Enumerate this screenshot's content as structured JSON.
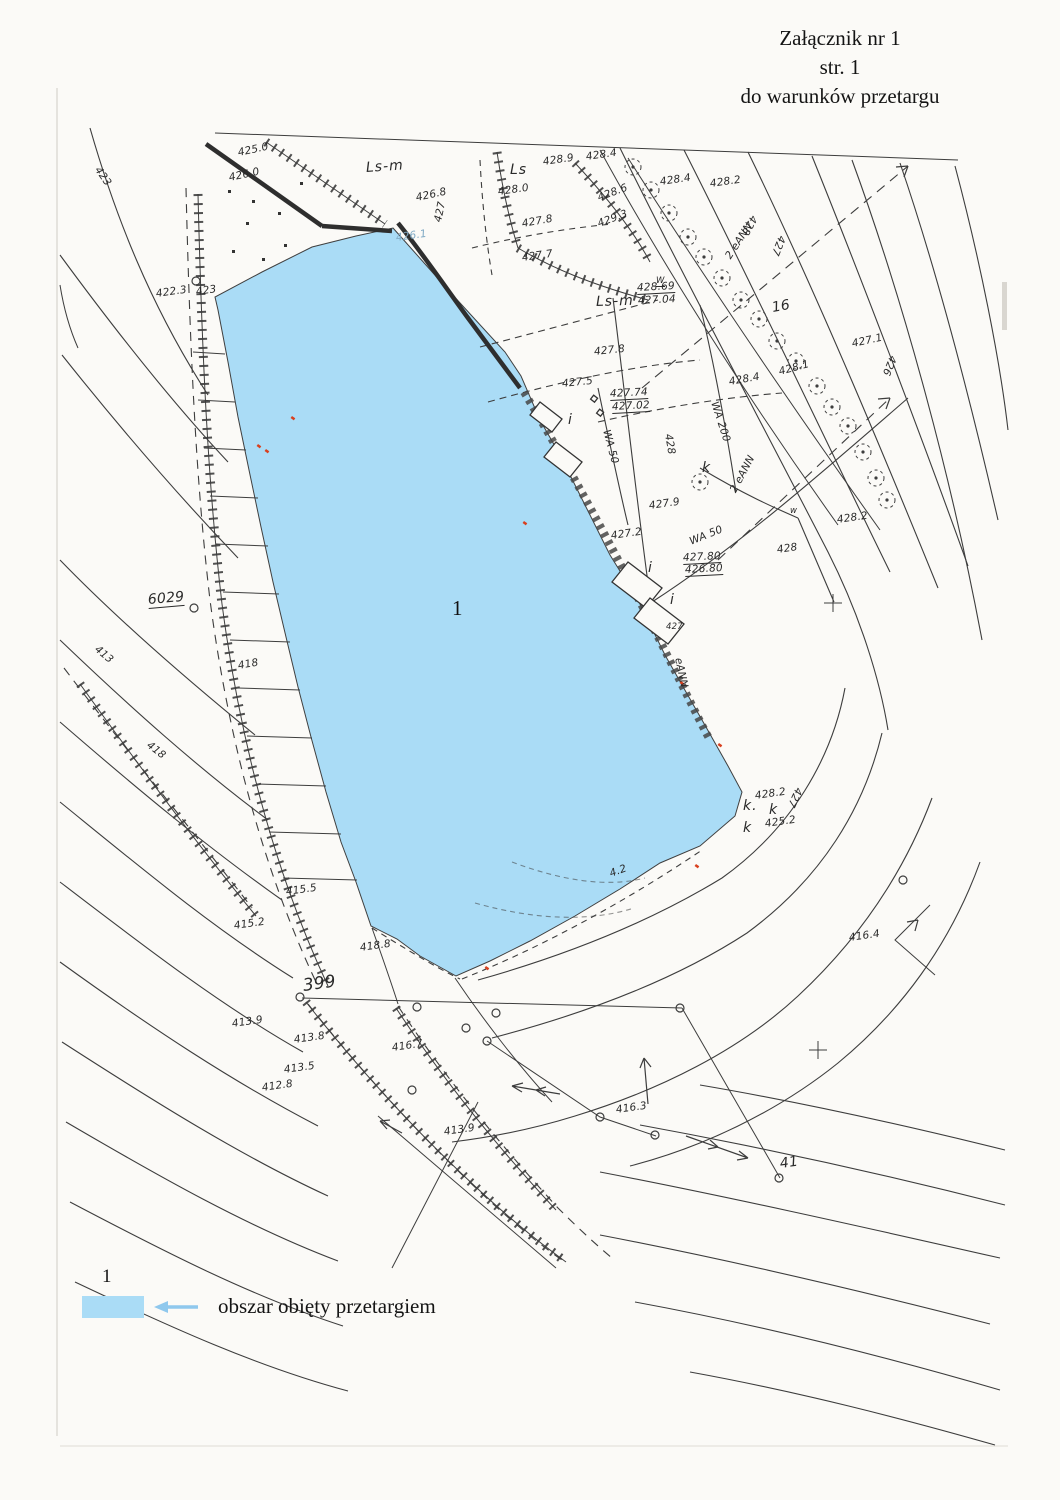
{
  "header": {
    "line1": "Załącznik nr 1",
    "line2": "str. 1",
    "line3": "do warunków przetargu"
  },
  "legend": {
    "area_number": "1",
    "label": "obszar obięty przetargiem",
    "swatch_color": "#aadcf6",
    "arrow_color": "#8fc8ed"
  },
  "map": {
    "area_label": "1",
    "water_color": "#aadcf6",
    "line_color": "#3d3d3d",
    "red_mark_color": "#d8401f",
    "labels": [
      {
        "t": "423",
        "x": 97,
        "y": 162,
        "r": 55
      },
      {
        "t": "425.0",
        "x": 238,
        "y": 147,
        "r": -12
      },
      {
        "t": "426.0",
        "x": 229,
        "y": 172,
        "r": -12
      },
      {
        "t": "Ls-m",
        "x": 366,
        "y": 160,
        "r": -4,
        "c": "ls"
      },
      {
        "t": "426.8",
        "x": 416,
        "y": 192,
        "r": -12
      },
      {
        "t": "427",
        "x": 438,
        "y": 216,
        "r": -78
      },
      {
        "t": "426.1",
        "x": 396,
        "y": 232,
        "r": -8,
        "c": "blue"
      },
      {
        "t": "Ls",
        "x": 510,
        "y": 162,
        "r": 0,
        "c": "ls"
      },
      {
        "t": "428.9",
        "x": 543,
        "y": 156,
        "r": -8
      },
      {
        "t": "428.4",
        "x": 586,
        "y": 151,
        "r": -8
      },
      {
        "t": "428.0",
        "x": 498,
        "y": 186,
        "r": -8
      },
      {
        "t": "428.6",
        "x": 598,
        "y": 192,
        "r": -20
      },
      {
        "t": "428.4",
        "x": 660,
        "y": 176,
        "r": -8
      },
      {
        "t": "428.2",
        "x": 710,
        "y": 178,
        "r": -8
      },
      {
        "t": "427.8",
        "x": 522,
        "y": 218,
        "r": -10
      },
      {
        "t": "429.3",
        "x": 598,
        "y": 218,
        "r": -20
      },
      {
        "t": "427.7",
        "x": 522,
        "y": 252,
        "r": -8
      },
      {
        "t": "2 eANN",
        "x": 728,
        "y": 252,
        "r": -57
      },
      {
        "t": "428",
        "x": 754,
        "y": 210,
        "r": 118
      },
      {
        "t": "427",
        "x": 782,
        "y": 230,
        "r": 112
      },
      {
        "t": "426",
        "x": 893,
        "y": 350,
        "r": 112
      },
      {
        "t": "427.1",
        "x": 852,
        "y": 338,
        "r": -12
      },
      {
        "t": "16",
        "x": 772,
        "y": 300,
        "r": -10,
        "c": "md"
      },
      {
        "t": "428.69",
        "x": 637,
        "y": 282,
        "r": -3,
        "u": 1
      },
      {
        "t": "427.04",
        "x": 638,
        "y": 295,
        "r": -3
      },
      {
        "t": "Ls-m",
        "x": 596,
        "y": 294,
        "r": -2,
        "c": "ls"
      },
      {
        "t": "427.8",
        "x": 594,
        "y": 346,
        "r": -6
      },
      {
        "t": "W",
        "x": 656,
        "y": 276,
        "r": 0,
        "u": 1,
        "c": "tiny"
      },
      {
        "t": "427.5",
        "x": 562,
        "y": 378,
        "r": -6
      },
      {
        "t": "427.74",
        "x": 610,
        "y": 388,
        "r": -3,
        "u": 1
      },
      {
        "t": "427.02",
        "x": 612,
        "y": 401,
        "r": -3,
        "u": 1
      },
      {
        "t": "i",
        "x": 568,
        "y": 412,
        "r": 0,
        "c": "ls"
      },
      {
        "t": "WA 50",
        "x": 606,
        "y": 424,
        "r": 75
      },
      {
        "t": "WA 200",
        "x": 714,
        "y": 396,
        "r": 72
      },
      {
        "t": "428.4",
        "x": 729,
        "y": 376,
        "r": -10
      },
      {
        "t": "428.1",
        "x": 779,
        "y": 366,
        "r": -15
      },
      {
        "t": "428",
        "x": 668,
        "y": 428,
        "r": 80
      },
      {
        "t": "k",
        "x": 702,
        "y": 460,
        "r": 0,
        "c": "ls"
      },
      {
        "t": "2 eANN",
        "x": 733,
        "y": 486,
        "r": -62
      },
      {
        "t": "427.9",
        "x": 649,
        "y": 500,
        "r": -8
      },
      {
        "t": "427.2",
        "x": 611,
        "y": 530,
        "r": -8
      },
      {
        "t": "428.2",
        "x": 837,
        "y": 514,
        "r": -8
      },
      {
        "t": "428",
        "x": 777,
        "y": 544,
        "r": -8
      },
      {
        "t": "427.80",
        "x": 683,
        "y": 552,
        "r": -3,
        "u": 1
      },
      {
        "t": "426.80",
        "x": 685,
        "y": 564,
        "r": -3,
        "u": 1
      },
      {
        "t": "i",
        "x": 648,
        "y": 560,
        "r": 0,
        "c": "ls"
      },
      {
        "t": "i",
        "x": 670,
        "y": 592,
        "r": 0,
        "c": "ls"
      },
      {
        "t": "427",
        "x": 666,
        "y": 622,
        "r": 0,
        "c": "tiny"
      },
      {
        "t": "eANN",
        "x": 678,
        "y": 652,
        "r": 78
      },
      {
        "t": "WA 50",
        "x": 690,
        "y": 536,
        "r": -22
      },
      {
        "t": "w",
        "x": 790,
        "y": 506,
        "r": 0,
        "c": "tiny"
      },
      {
        "t": "428.2",
        "x": 755,
        "y": 790,
        "r": -8
      },
      {
        "t": "k.",
        "x": 743,
        "y": 798,
        "r": 0,
        "c": "ls"
      },
      {
        "t": "k",
        "x": 769,
        "y": 802,
        "r": 0,
        "c": "ls"
      },
      {
        "t": "k",
        "x": 743,
        "y": 820,
        "r": 0,
        "c": "ls"
      },
      {
        "t": "425.2",
        "x": 765,
        "y": 818,
        "r": -8
      },
      {
        "t": "427",
        "x": 799,
        "y": 782,
        "r": 115
      },
      {
        "t": "416.4",
        "x": 849,
        "y": 932,
        "r": -8
      },
      {
        "t": "6029",
        "x": 148,
        "y": 592,
        "r": -5,
        "u": 1,
        "c": "md"
      },
      {
        "t": "422.3",
        "x": 156,
        "y": 288,
        "r": -8
      },
      {
        "t": "423",
        "x": 196,
        "y": 286,
        "r": -8
      },
      {
        "t": "413",
        "x": 96,
        "y": 642,
        "r": 40
      },
      {
        "t": "418",
        "x": 238,
        "y": 660,
        "r": -10
      },
      {
        "t": "418",
        "x": 148,
        "y": 738,
        "r": 38
      },
      {
        "t": "415.5",
        "x": 286,
        "y": 886,
        "r": -8
      },
      {
        "t": "415.2",
        "x": 234,
        "y": 920,
        "r": -8
      },
      {
        "t": "418.8",
        "x": 360,
        "y": 942,
        "r": -8
      },
      {
        "t": "399",
        "x": 303,
        "y": 976,
        "r": -8,
        "c": "md2"
      },
      {
        "t": "413.9",
        "x": 232,
        "y": 1018,
        "r": -8
      },
      {
        "t": "413.8",
        "x": 294,
        "y": 1034,
        "r": -8
      },
      {
        "t": "413.5",
        "x": 284,
        "y": 1064,
        "r": -8
      },
      {
        "t": "412.8",
        "x": 262,
        "y": 1082,
        "r": -8
      },
      {
        "t": "416.7",
        "x": 392,
        "y": 1042,
        "r": -8
      },
      {
        "t": "413.9",
        "x": 444,
        "y": 1126,
        "r": -8
      },
      {
        "t": "416.3",
        "x": 616,
        "y": 1104,
        "r": -8
      },
      {
        "t": "41",
        "x": 780,
        "y": 1156,
        "r": -8,
        "c": "md"
      },
      {
        "t": "4.2",
        "x": 610,
        "y": 868,
        "r": -20
      },
      {
        "t": "1",
        "x": 452,
        "y": 596,
        "r": 0,
        "c": "big"
      }
    ],
    "trees": [
      [
        633,
        167
      ],
      [
        651,
        190
      ],
      [
        669,
        213
      ],
      [
        688,
        237
      ],
      [
        704,
        257
      ],
      [
        722,
        278
      ],
      [
        741,
        300
      ],
      [
        759,
        319
      ],
      [
        777,
        341
      ],
      [
        796,
        361
      ],
      [
        817,
        386
      ],
      [
        832,
        407
      ],
      [
        848,
        426
      ],
      [
        863,
        452
      ],
      [
        876,
        478
      ],
      [
        887,
        500
      ],
      [
        700,
        482
      ]
    ],
    "points": [
      [
        196,
        281
      ],
      [
        194,
        608
      ],
      [
        300,
        997
      ],
      [
        417,
        1007
      ],
      [
        466,
        1028
      ],
      [
        487,
        1041
      ],
      [
        496,
        1013
      ],
      [
        600,
        1117
      ],
      [
        655,
        1135
      ],
      [
        680,
        1008
      ],
      [
        779,
        1178
      ],
      [
        903,
        880
      ],
      [
        412,
        1090
      ]
    ],
    "crosses": [
      [
        833,
        603
      ],
      [
        818,
        1050
      ]
    ],
    "red_marks": [
      [
        258,
        444
      ],
      [
        266,
        449
      ],
      [
        486,
        966
      ],
      [
        696,
        864
      ],
      [
        681,
        681
      ],
      [
        719,
        743
      ],
      [
        524,
        521
      ],
      [
        292,
        416
      ]
    ],
    "orchard_dots": [
      [
        228,
        190
      ],
      [
        252,
        200
      ],
      [
        278,
        212
      ],
      [
        300,
        182
      ],
      [
        232,
        250
      ],
      [
        262,
        258
      ],
      [
        284,
        244
      ],
      [
        246,
        222
      ]
    ]
  }
}
